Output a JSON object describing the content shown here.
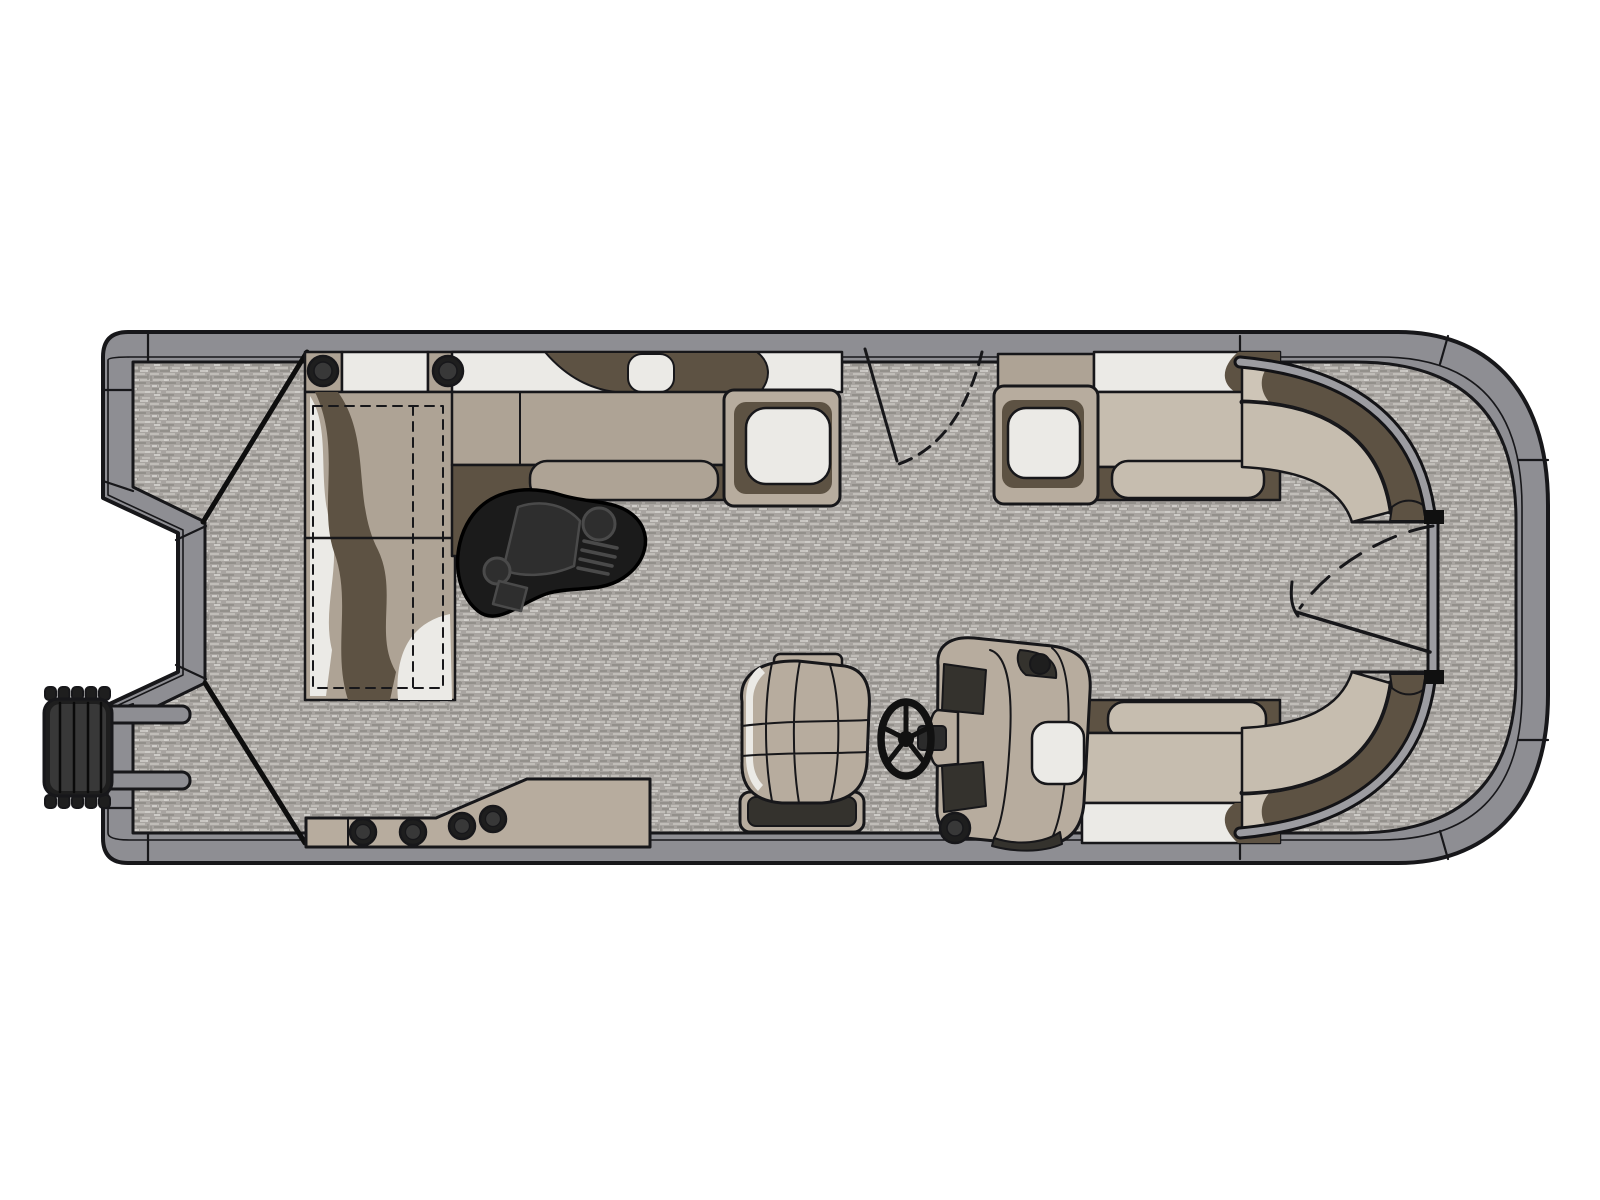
{
  "diagram": {
    "type": "pontoon-boat-floor-plan",
    "view": "top-down",
    "parts": [
      "hull-rim",
      "deck-carpet",
      "outboard-motor",
      "stern-fence-line",
      "rear-l-lounge",
      "speaker",
      "underseat-storage",
      "cocktail-table",
      "port-aft-bench",
      "armrest",
      "side-gate",
      "bow-port-bench",
      "bow-starboard-bench",
      "bow-fence-rail",
      "bow-gate",
      "helm-console",
      "steering-wheel",
      "captain-chair",
      "stereo-shelf"
    ]
  },
  "colors": {
    "page_bg": "#ffffff",
    "outline": "#17171a",
    "stern_line": "#0e0e0e",
    "rim_gray": "#8e8e93",
    "fence_gray": "#9c9ca1",
    "floor_base": "#a8a4a0",
    "floor_light": "#c0bdb8",
    "floor_dark": "#93908b",
    "floor_white": "#dbd9d5",
    "seat_tan": "#aea395",
    "seat_tan_light": "#c6bdaf",
    "seat_cream": "#cec5b7",
    "seat_white": "#ebeae6",
    "brown_dark": "#5d5243",
    "console_tan": "#b7ac9e",
    "dark_panel": "#34322d",
    "black_part": "#1e1e1e",
    "black_soft": "#383838",
    "table_black": "#1b1b1b",
    "table_panel": "#2e2e2e",
    "table_line": "#4a4a4a"
  }
}
